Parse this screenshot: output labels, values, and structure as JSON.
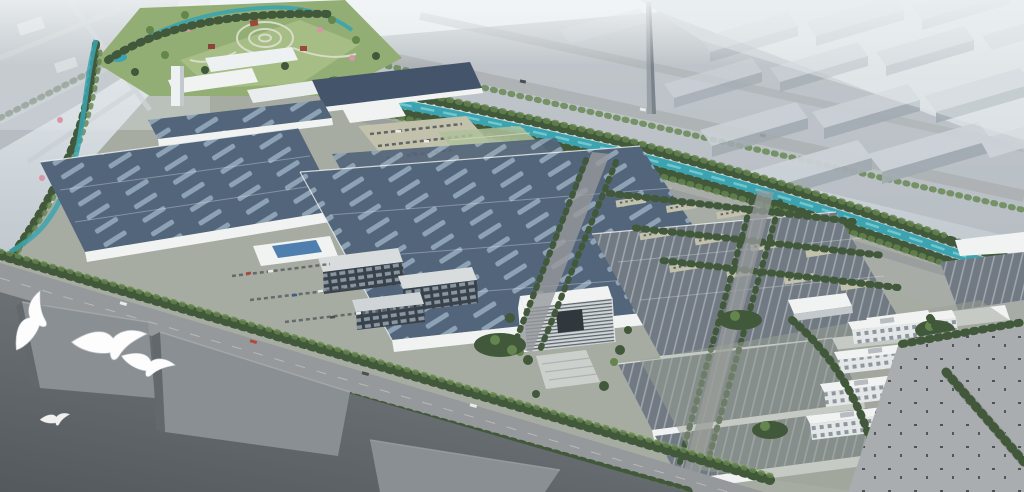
{
  "scene": {
    "label": "Aerial architectural rendering of an industrial park campus beside a canal",
    "type": "aerial-architectural-rendering",
    "subject": "industrial-park-campus",
    "bird_count": 4,
    "features": [
      "landscaped park with circular garden",
      "winding canal with tree banks",
      "navy solar-panel factory roofs",
      "gray ribbed factory roofs",
      "central white office building",
      "dormitory blocks",
      "sports court",
      "tree-lined boulevard",
      "foreground warehouses",
      "flying seagulls",
      "tall chimney",
      "hazy city blocks in background"
    ]
  },
  "palette": {
    "haze_top": "#e9edf0",
    "haze_low": "#b9c2c9",
    "city_gray": "#b5bbc1",
    "block_top": "#ccd2d7",
    "block_side": "#a3abb2",
    "canal": "#3ba4b0",
    "canal_light": "#7fd0d6",
    "tree_dark": "#41593a",
    "tree_mid": "#64854d",
    "lawn": "#93ae74",
    "lawn_light": "#b3c693",
    "ground": "#a6aca2",
    "road": "#96999b",
    "road_light": "#a9adaf",
    "roof_navy": "#53657a",
    "roof_navy_dark": "#44546a",
    "skylight": "#90a5b8",
    "roof_gray": "#717a82",
    "rib_light": "#a9b0b7",
    "wall_white": "#f1f3f3",
    "win_dark": "#39414a",
    "win_lite": "#97a5b1",
    "dorm_wall": "#e4e7e8",
    "dorm_win": "#8f979e",
    "fg_dark": "#5d6266",
    "fg_block": "#8a8f93",
    "fg_block_dark": "#63686c",
    "court": "#2c6b49",
    "blossom": "#d995a8",
    "tan": "#c2c2ac",
    "car_red": "#b0493c",
    "car_white": "#e8eaec",
    "car_dark": "#4a4f54",
    "chimney": "#9aa1a7",
    "bird": "#fdfdfd"
  }
}
